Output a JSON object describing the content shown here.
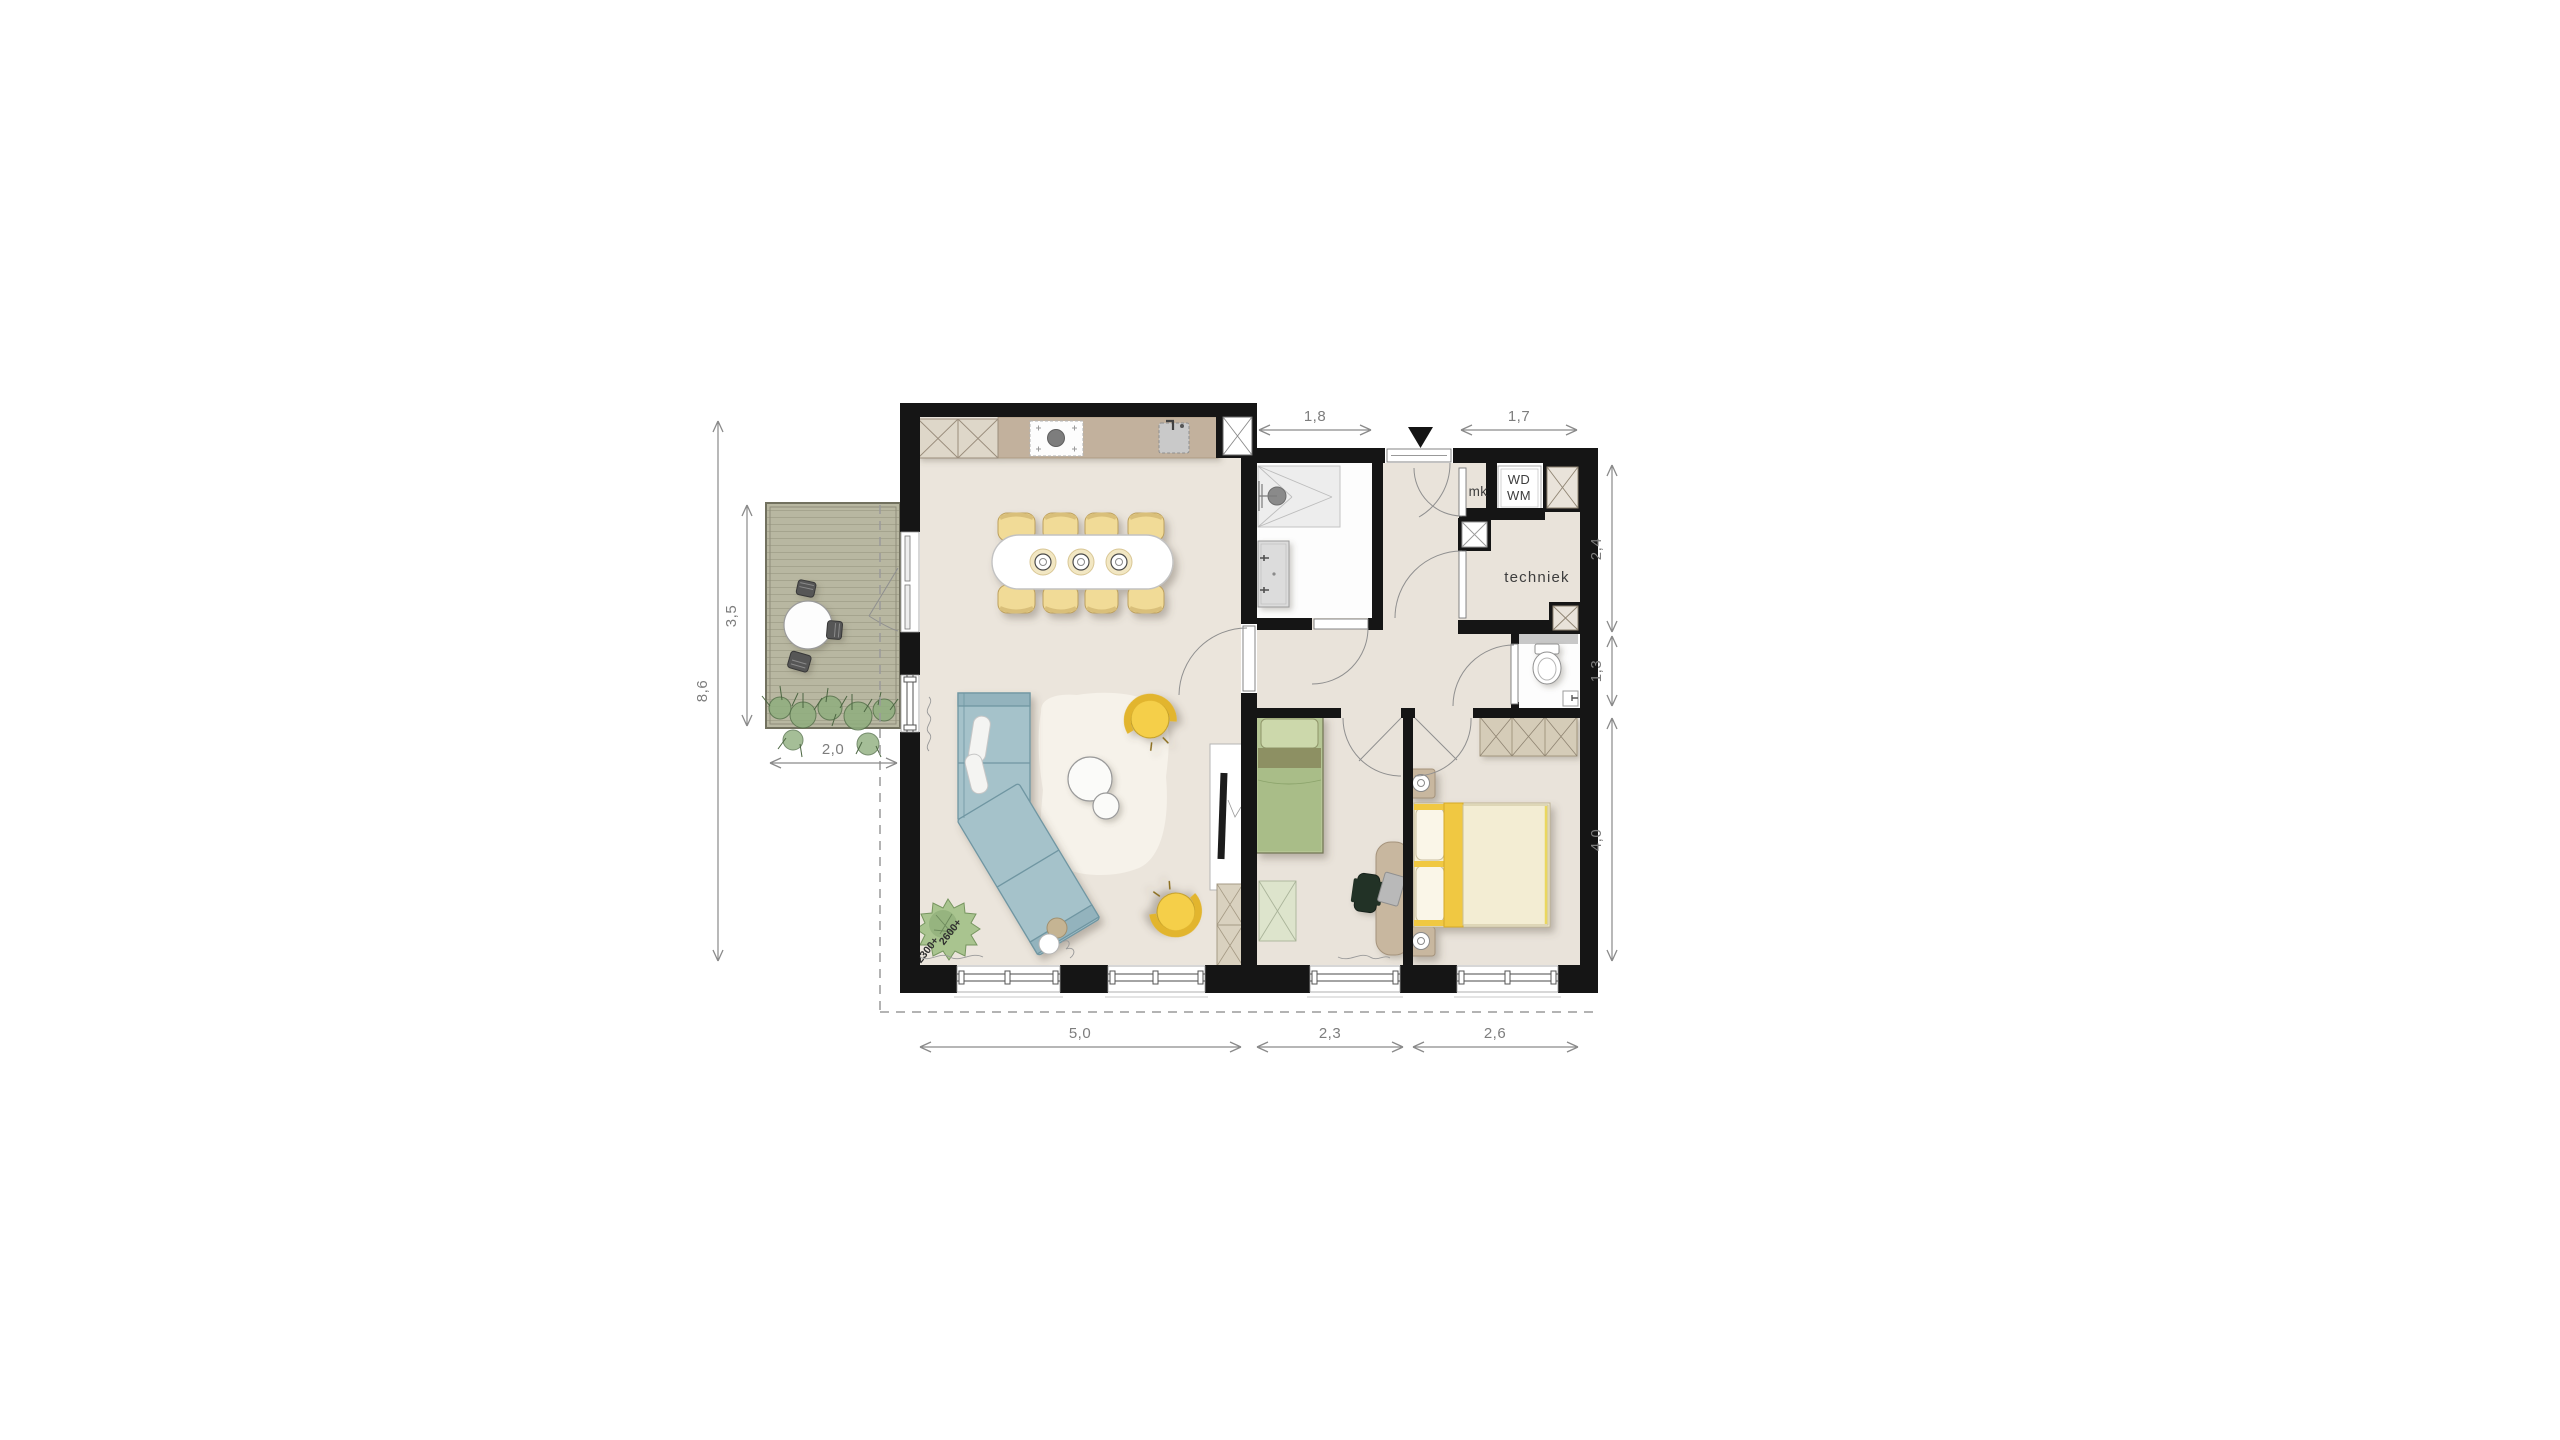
{
  "floorplan": {
    "dimension_labels": {
      "overall_height": "8,6",
      "balcony_height": "3,5",
      "balcony_width": "2,0",
      "bathroom_width": "1,8",
      "storage_width": "1,7",
      "hall_zone_height": "2,4",
      "toilet_height": "1,3",
      "bedroom_height": "4,0",
      "living_width": "5,0",
      "bedroom1_width": "2,3",
      "bedroom2_width": "2,6"
    },
    "room_labels": {
      "techniek": "techniek",
      "meter_cupboard": "mk",
      "washer": "WD",
      "dryer": "WM"
    },
    "level_annotations": {
      "upper": "2600+",
      "lower": "2300+"
    },
    "palette": {
      "wall": "#151515",
      "floor": "#ebe5dc",
      "wet_room_floor": "#fdfdfd",
      "kitchen_counter": "#c2b19d",
      "accent_yellow": "#f2cf4a",
      "sofa_blue": "#a5c2ca",
      "bed_green": "#b3c494",
      "balcony_deck": "#b8b7a1",
      "dimension_text": "#7d7d7d"
    }
  }
}
